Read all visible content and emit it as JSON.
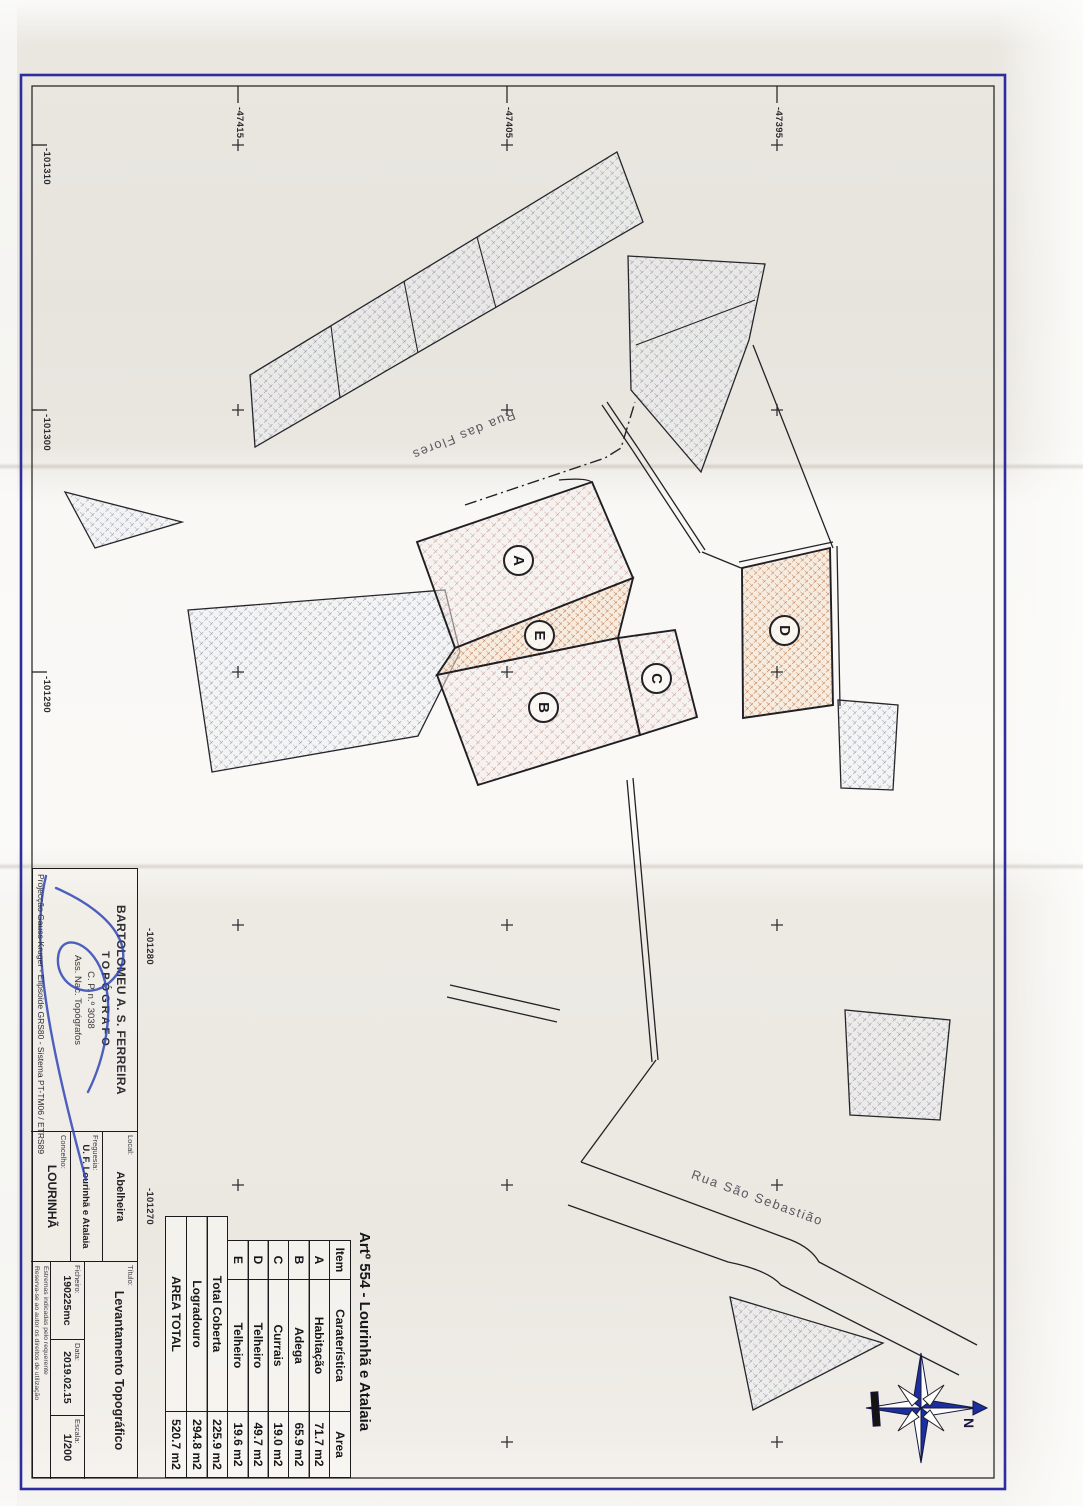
{
  "plan": {
    "parcel_labels": {
      "a": "A",
      "b": "B",
      "c": "C",
      "d": "D",
      "e": "E"
    },
    "streets": {
      "flores": "Rua das Flores",
      "sebastiao": "Rua São Sebastião"
    },
    "grid": {
      "bottom_labels": [
        "-101310",
        "-101300",
        "-101290",
        "-101280",
        "-101270"
      ],
      "left_labels": [
        "-47395",
        "-47405",
        "-47415"
      ]
    },
    "compass": {
      "north_label": "N"
    }
  },
  "annotation_table": {
    "title": "Artº 554 - Lourinhã e Atalaia",
    "headers": {
      "item": "Item",
      "caracteristica": "Caraterística",
      "area": "Area"
    },
    "rows": [
      {
        "item": "A",
        "caracteristica": "Habitação",
        "area": "71.7 m2"
      },
      {
        "item": "B",
        "caracteristica": "Adega",
        "area": "65.9 m2"
      },
      {
        "item": "C",
        "caracteristica": "Currais",
        "area": "19.0 m2"
      },
      {
        "item": "D",
        "caracteristica": "Telheiro",
        "area": "49.7 m2"
      },
      {
        "item": "E",
        "caracteristica": "Telheiro",
        "area": "19.6 m2"
      }
    ],
    "totals": [
      {
        "label": "Total Coberta",
        "value": "225.9 m2"
      },
      {
        "label": "Logradouro",
        "value": "294.8 m2"
      },
      {
        "label": "AREA TOTAL",
        "value": "520.7 m2"
      }
    ]
  },
  "title_block": {
    "stamp": {
      "line1": "BARTOLOMEU A. S. FERREIRA",
      "line2": "TOPÓGRAFO",
      "line3": "C. P. n.º 3038",
      "line4": "Ass. Nac. Topógrafos"
    },
    "fields": {
      "local": {
        "label": "Local:",
        "value": "Abelheira"
      },
      "freguesia": {
        "label": "Freguesia:",
        "value": "U. F. Lourinhã e Atalaia"
      },
      "concelho": {
        "label": "Concelho:",
        "value": "LOURINHÃ"
      },
      "titulo": {
        "label": "Título:",
        "value": "Levantamento Topográfico"
      },
      "ficheiro": {
        "label": "Ficheiro:",
        "value": "190225mc"
      },
      "data": {
        "label": "Data:",
        "value": "2019.02.15"
      },
      "escala": {
        "label": "Escala:",
        "value": "1/200"
      }
    },
    "fine_print": [
      "Estremas indicadas pelo requerente",
      "Reserva-se ao autor os direitos de utilização"
    ],
    "projection": "Projecção Gauss-Kruger - Elipsoide GRS80 - Sistema PT-TM06 / ETRS89"
  },
  "colors": {
    "frame_blue": "#2d2da0",
    "ink": "#1d1d1f",
    "hatch_gray": "#8f94a8",
    "hatch_pink": "#c49890",
    "hatch_orange": "#c0794e",
    "signature_blue": "#2f45b5"
  }
}
